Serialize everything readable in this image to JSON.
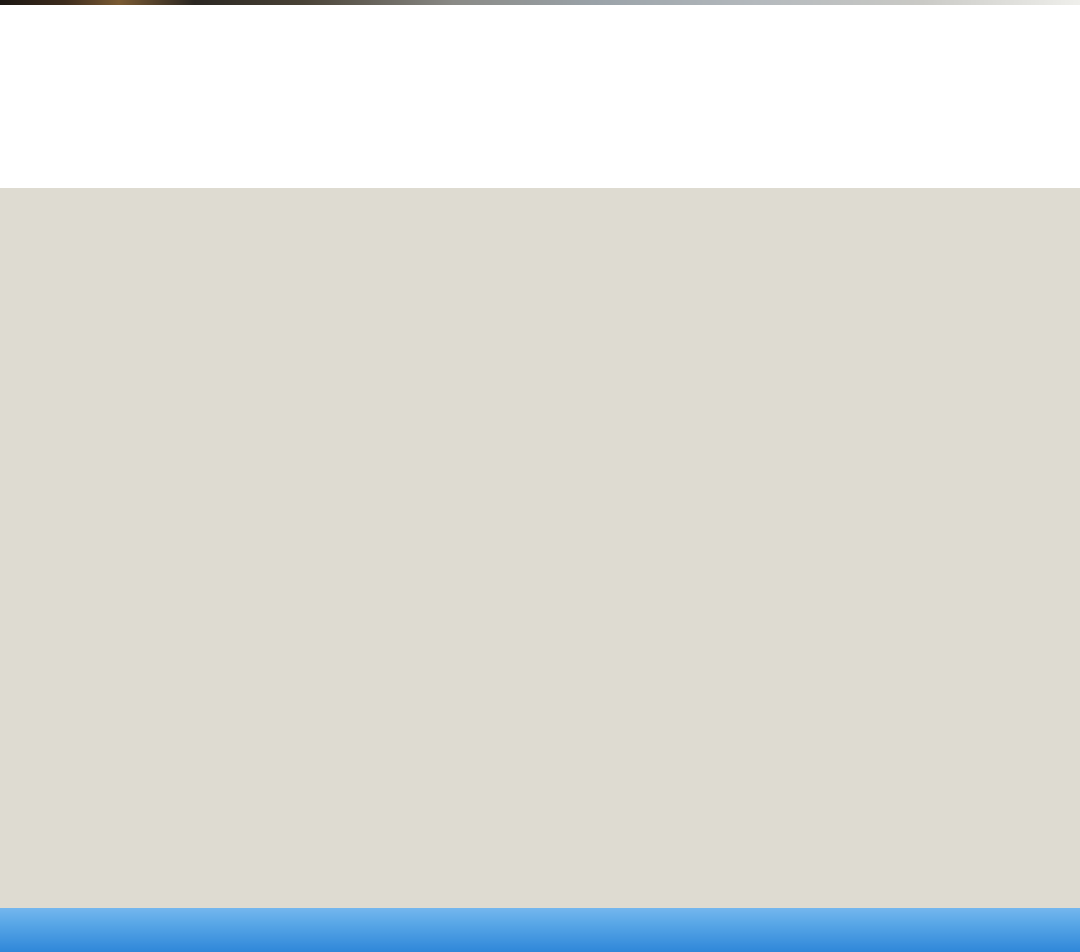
{
  "header": {
    "section_number": "01",
    "title": "多机协作",
    "subtitle": "最大可支持6路画面同屏显示，支持主从设备之间屏幕分享和一键广播"
  },
  "palette": {
    "scene_background": "#dedbd1",
    "caption_bar_top": "#74b7ee",
    "caption_bar_bottom": "#2f87d9",
    "divider_blue": "#1e88e5",
    "group_red": "#f15b5b",
    "group_blue": "#4aa5f2",
    "group_yellow": "#f8d33e",
    "group_magenta": "#d966f0",
    "mirror_red": "#f26d6d",
    "device_navy": "#16294a",
    "panel_dark": "#3f4246"
  },
  "scene": {
    "background": "#dedbd1",
    "whiteboards": [
      "function-graph",
      "handwritten-notes",
      "function-graph",
      "function-graph"
    ],
    "tv_panels": 2,
    "wireless_receivers": 5,
    "desk_rows": 4,
    "students_per_desk": 3,
    "shirt_colors": [
      "#e3433b",
      "#5a9fe0",
      "#48b39c",
      "#6fc05a"
    ]
  },
  "diagrams": [
    {
      "caption": "主屏广播",
      "teacher_board_label": "Teacher",
      "teacher_screen": {
        "mode": "single",
        "cells": [
          {
            "text": "Teacher",
            "bg": "#ffffff",
            "fg": "#1a1a1a"
          }
        ]
      },
      "stations": [
        {
          "label": "A 组",
          "cells": [
            {
              "text": "Teacher",
              "bg": "#ffffff",
              "fg": "#1a1a1a"
            }
          ]
        },
        {
          "label": "B 组",
          "cells": [
            {
              "text": "Teacher",
              "bg": "#ffffff",
              "fg": "#1a1a1a"
            }
          ]
        },
        {
          "label": "C 组",
          "cells": [
            {
              "text": "Teacher",
              "bg": "#ffffff",
              "fg": "#1a1a1a"
            }
          ]
        },
        {
          "label": "D 组",
          "cells": [
            {
              "text": "Teacher",
              "bg": "#ffffff",
              "fg": "#1a1a1a"
            }
          ]
        }
      ],
      "links": [
        {
          "from": "podium",
          "to": [
            "A",
            "B",
            "C",
            "D"
          ],
          "style": "white-dashed"
        }
      ]
    },
    {
      "caption": "小组投屏",
      "teacher_board_label": "Teacher",
      "teacher_screen": {
        "mode": "quad",
        "cells": [
          {
            "text": "A组",
            "bg": "#f15b5b",
            "fg": "#ffffff"
          },
          {
            "text": "B组",
            "bg": "#4aa5f2",
            "fg": "#ffffff"
          },
          {
            "text": "C组",
            "bg": "#f8d33e",
            "fg": "#ffffff"
          },
          {
            "text": "D组",
            "bg": "#d966f0",
            "fg": "#ffffff"
          }
        ]
      },
      "stations": [
        {
          "label": "A 组",
          "cells": [
            {
              "text": "A组",
              "bg": "#f15b5b",
              "fg": "#ffffff"
            }
          ]
        },
        {
          "label": "B 组",
          "cells": [
            {
              "text": "B组",
              "bg": "#4aa5f2",
              "fg": "#ffffff"
            }
          ]
        },
        {
          "label": "C 组",
          "cells": [
            {
              "text": "C组",
              "bg": "#f8d33e",
              "fg": "#ffffff"
            }
          ]
        },
        {
          "label": "D 组",
          "cells": [
            {
              "text": "D组",
              "bg": "#d966f0",
              "fg": "#ffffff"
            }
          ]
        }
      ],
      "links": [
        {
          "from": "podium",
          "to": [
            "A",
            "B",
            "C",
            "D"
          ],
          "style": "white-dashed"
        }
      ]
    },
    {
      "caption": "多屏互动",
      "teacher_board_label": "Teacher",
      "teacher_screen": {
        "mode": "split",
        "cells": [
          {
            "text": "Teacher",
            "bg": "#ffffff",
            "fg": "#1a1a1a"
          },
          {
            "text": "A组",
            "bg": "#f26d6d",
            "fg": "#ffffff"
          }
        ]
      },
      "stations": [
        {
          "label": "A 组",
          "cells": [
            {
              "text": "A组",
              "bg": "#f26d6d",
              "fg": "#ffffff"
            }
          ]
        },
        {
          "label": "B 组",
          "cells": [
            {
              "text": "Teacher",
              "bg": "#ffffff",
              "fg": "#1a1a1a"
            },
            {
              "text": "A组",
              "bg": "#f26d6d",
              "fg": "#ffffff"
            }
          ]
        },
        {
          "label": "C 组",
          "cells": [
            {
              "text": "Teacher",
              "bg": "#ffffff",
              "fg": "#1a1a1a"
            },
            {
              "text": "A组",
              "bg": "#f26d6d",
              "fg": "#ffffff"
            }
          ]
        },
        {
          "label": "D 组",
          "cells": [
            {
              "text": "Teacher",
              "bg": "#ffffff",
              "fg": "#1a1a1a"
            },
            {
              "text": "A组",
              "bg": "#f26d6d",
              "fg": "#ffffff"
            }
          ]
        }
      ],
      "links": [
        {
          "from": "A",
          "to": [
            "podium"
          ],
          "style": "red-dashed-arrow"
        },
        {
          "from": "podium",
          "to": [
            "B",
            "C",
            "D"
          ],
          "style": "white-dashed-arrow"
        }
      ]
    }
  ]
}
